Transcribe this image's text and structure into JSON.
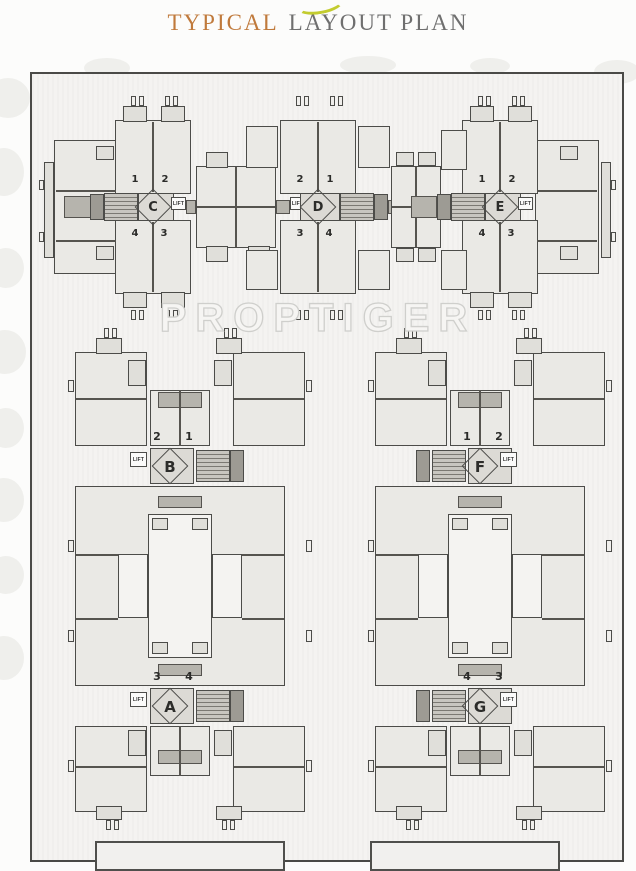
{
  "header": {
    "title_accent": "TYPICAL",
    "title_rest": "LAYOUT PLAN"
  },
  "watermark": "PROPTIGER",
  "lift_label": "LIFT",
  "buildings": [
    {
      "id": "C",
      "label": "C",
      "lift_side": "right",
      "corners": {
        "tl": "1",
        "tr": "2",
        "bl": "4",
        "br": "3"
      }
    },
    {
      "id": "D",
      "label": "D",
      "lift_side": "left",
      "corners": {
        "tl": "2",
        "tr": "1",
        "bl": "3",
        "br": "4"
      }
    },
    {
      "id": "E",
      "label": "E",
      "lift_side": "right",
      "corners": {
        "tl": "1",
        "tr": "2",
        "bl": "4",
        "br": "3"
      }
    },
    {
      "id": "B",
      "label": "B",
      "lift_side": "left",
      "corners": {
        "tl": "2",
        "tr": "1",
        "bl": "3",
        "br": "4"
      }
    },
    {
      "id": "F",
      "label": "F",
      "lift_side": "right",
      "corners": {
        "tl": "1",
        "tr": "2",
        "bl": "4",
        "br": "3"
      }
    },
    {
      "id": "A",
      "label": "A",
      "lift_side": "left",
      "corners": {
        "tl": "3",
        "tr": "4",
        "bl": "2",
        "br": "1"
      }
    },
    {
      "id": "G",
      "label": "G",
      "lift_side": "right",
      "corners": {
        "tl": "4",
        "tr": "3",
        "bl": "1",
        "br": "2"
      }
    }
  ],
  "colors": {
    "title_accent": "#c07a3c",
    "title_gray": "#6f6f6f",
    "swoosh": "#c3cc2f",
    "wall_line": "#4c4c49",
    "plan_bg": "#f4f3f1"
  }
}
